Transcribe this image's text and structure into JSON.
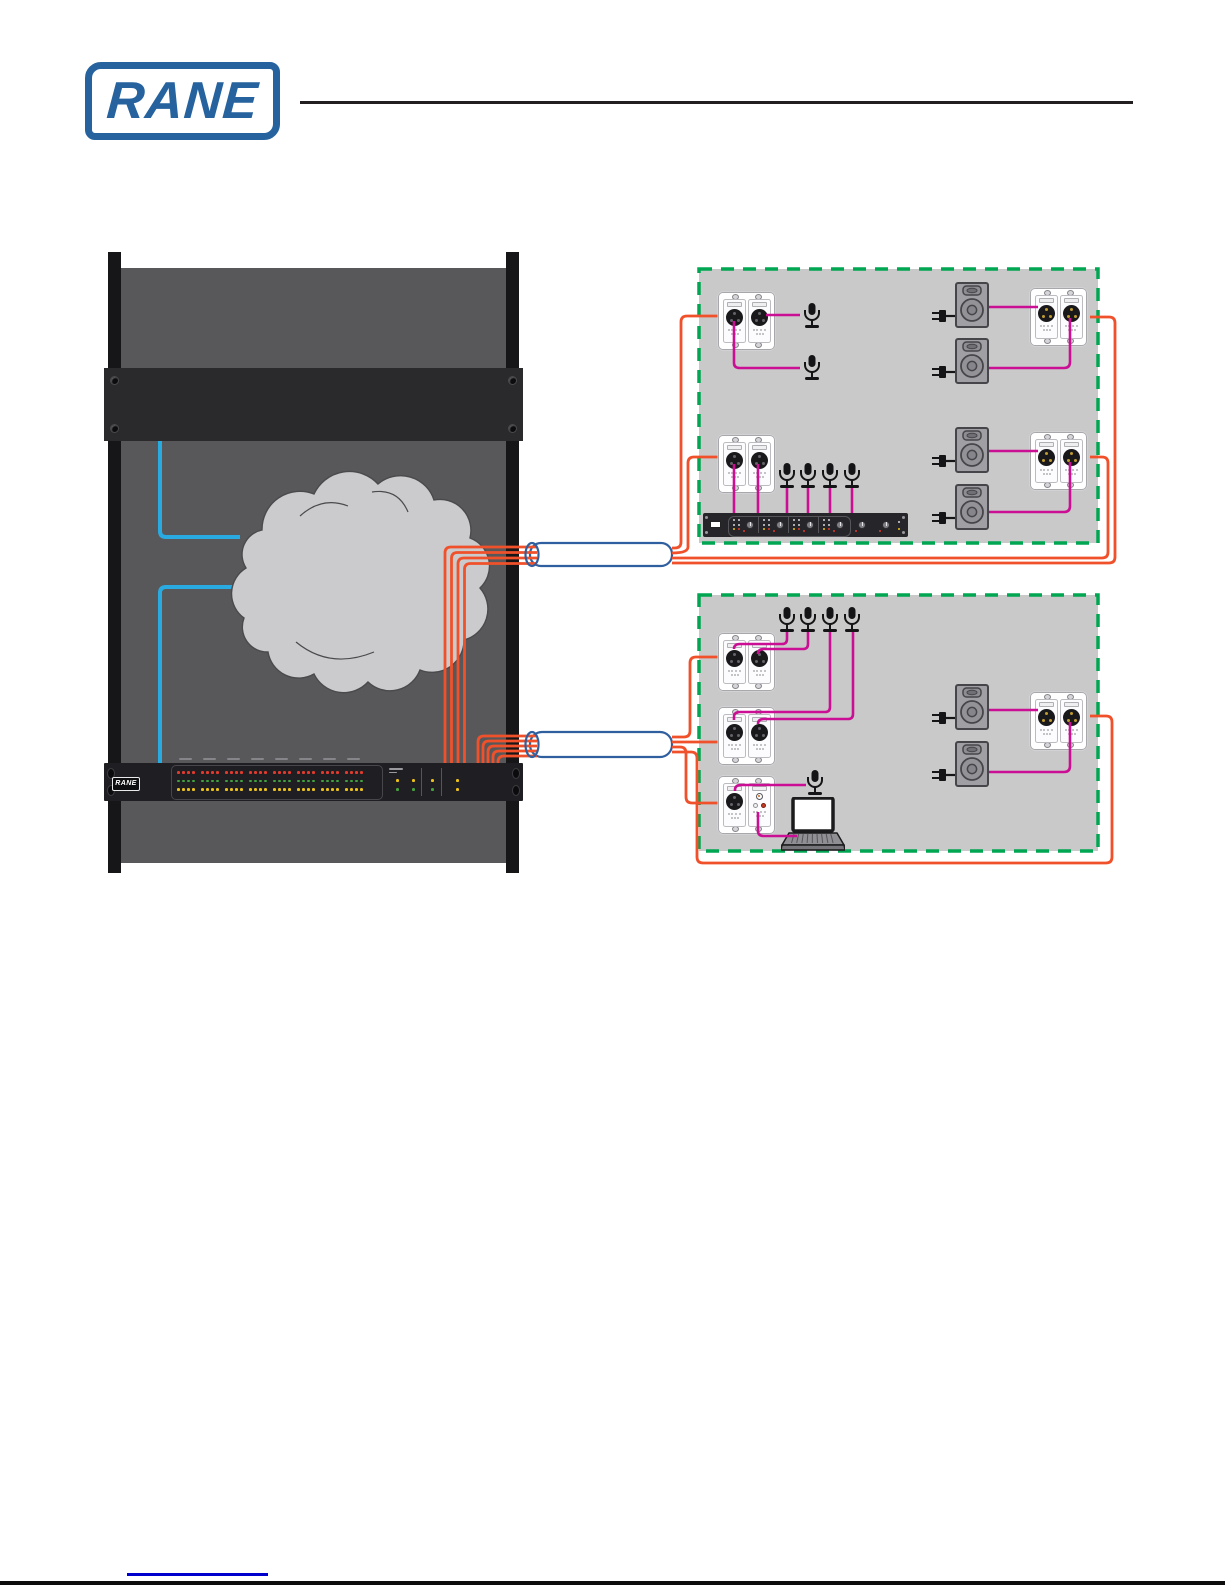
{
  "header": {
    "brand": "RANE"
  },
  "colors": {
    "orange": "#F0512B",
    "magenta": "#CB0F94",
    "cable_blue": "#29ABE2",
    "bundle_outline": "#2F5F9E",
    "room_border_green": "#00A651",
    "room_fill": "#C9C9C9",
    "rack_panel_gray": "#58585A",
    "rack_dark": "#2A2A2C",
    "rack_rail": "#161618",
    "device_black": "#1F1F23",
    "led_red": "#E23A2C",
    "led_green": "#44A13F",
    "led_yellow": "#EDC11C",
    "logo_blue": "#26639E",
    "link_blue": "#0000CC"
  },
  "rack": {
    "device_logo": "RANE",
    "led_meter": {
      "groups": 8,
      "columns": 4,
      "rows": [
        "red",
        "green",
        "yellow"
      ]
    },
    "status_leds": [
      [
        "yellow",
        "green"
      ],
      [
        "yellow",
        "green"
      ],
      [
        "yellow",
        "green"
      ],
      [
        "yellow",
        "yellow"
      ]
    ]
  },
  "network": {
    "cloud": "network-cloud",
    "cat5_bundles": 2
  },
  "rooms": [
    {
      "id": "room-1",
      "wallplates": 4,
      "microphones": 6,
      "speakers": 4,
      "automixer": {
        "channels": 4
      }
    },
    {
      "id": "room-2",
      "wallplates": 4,
      "microphones": 5,
      "speakers": 2,
      "laptops": 1
    }
  ]
}
